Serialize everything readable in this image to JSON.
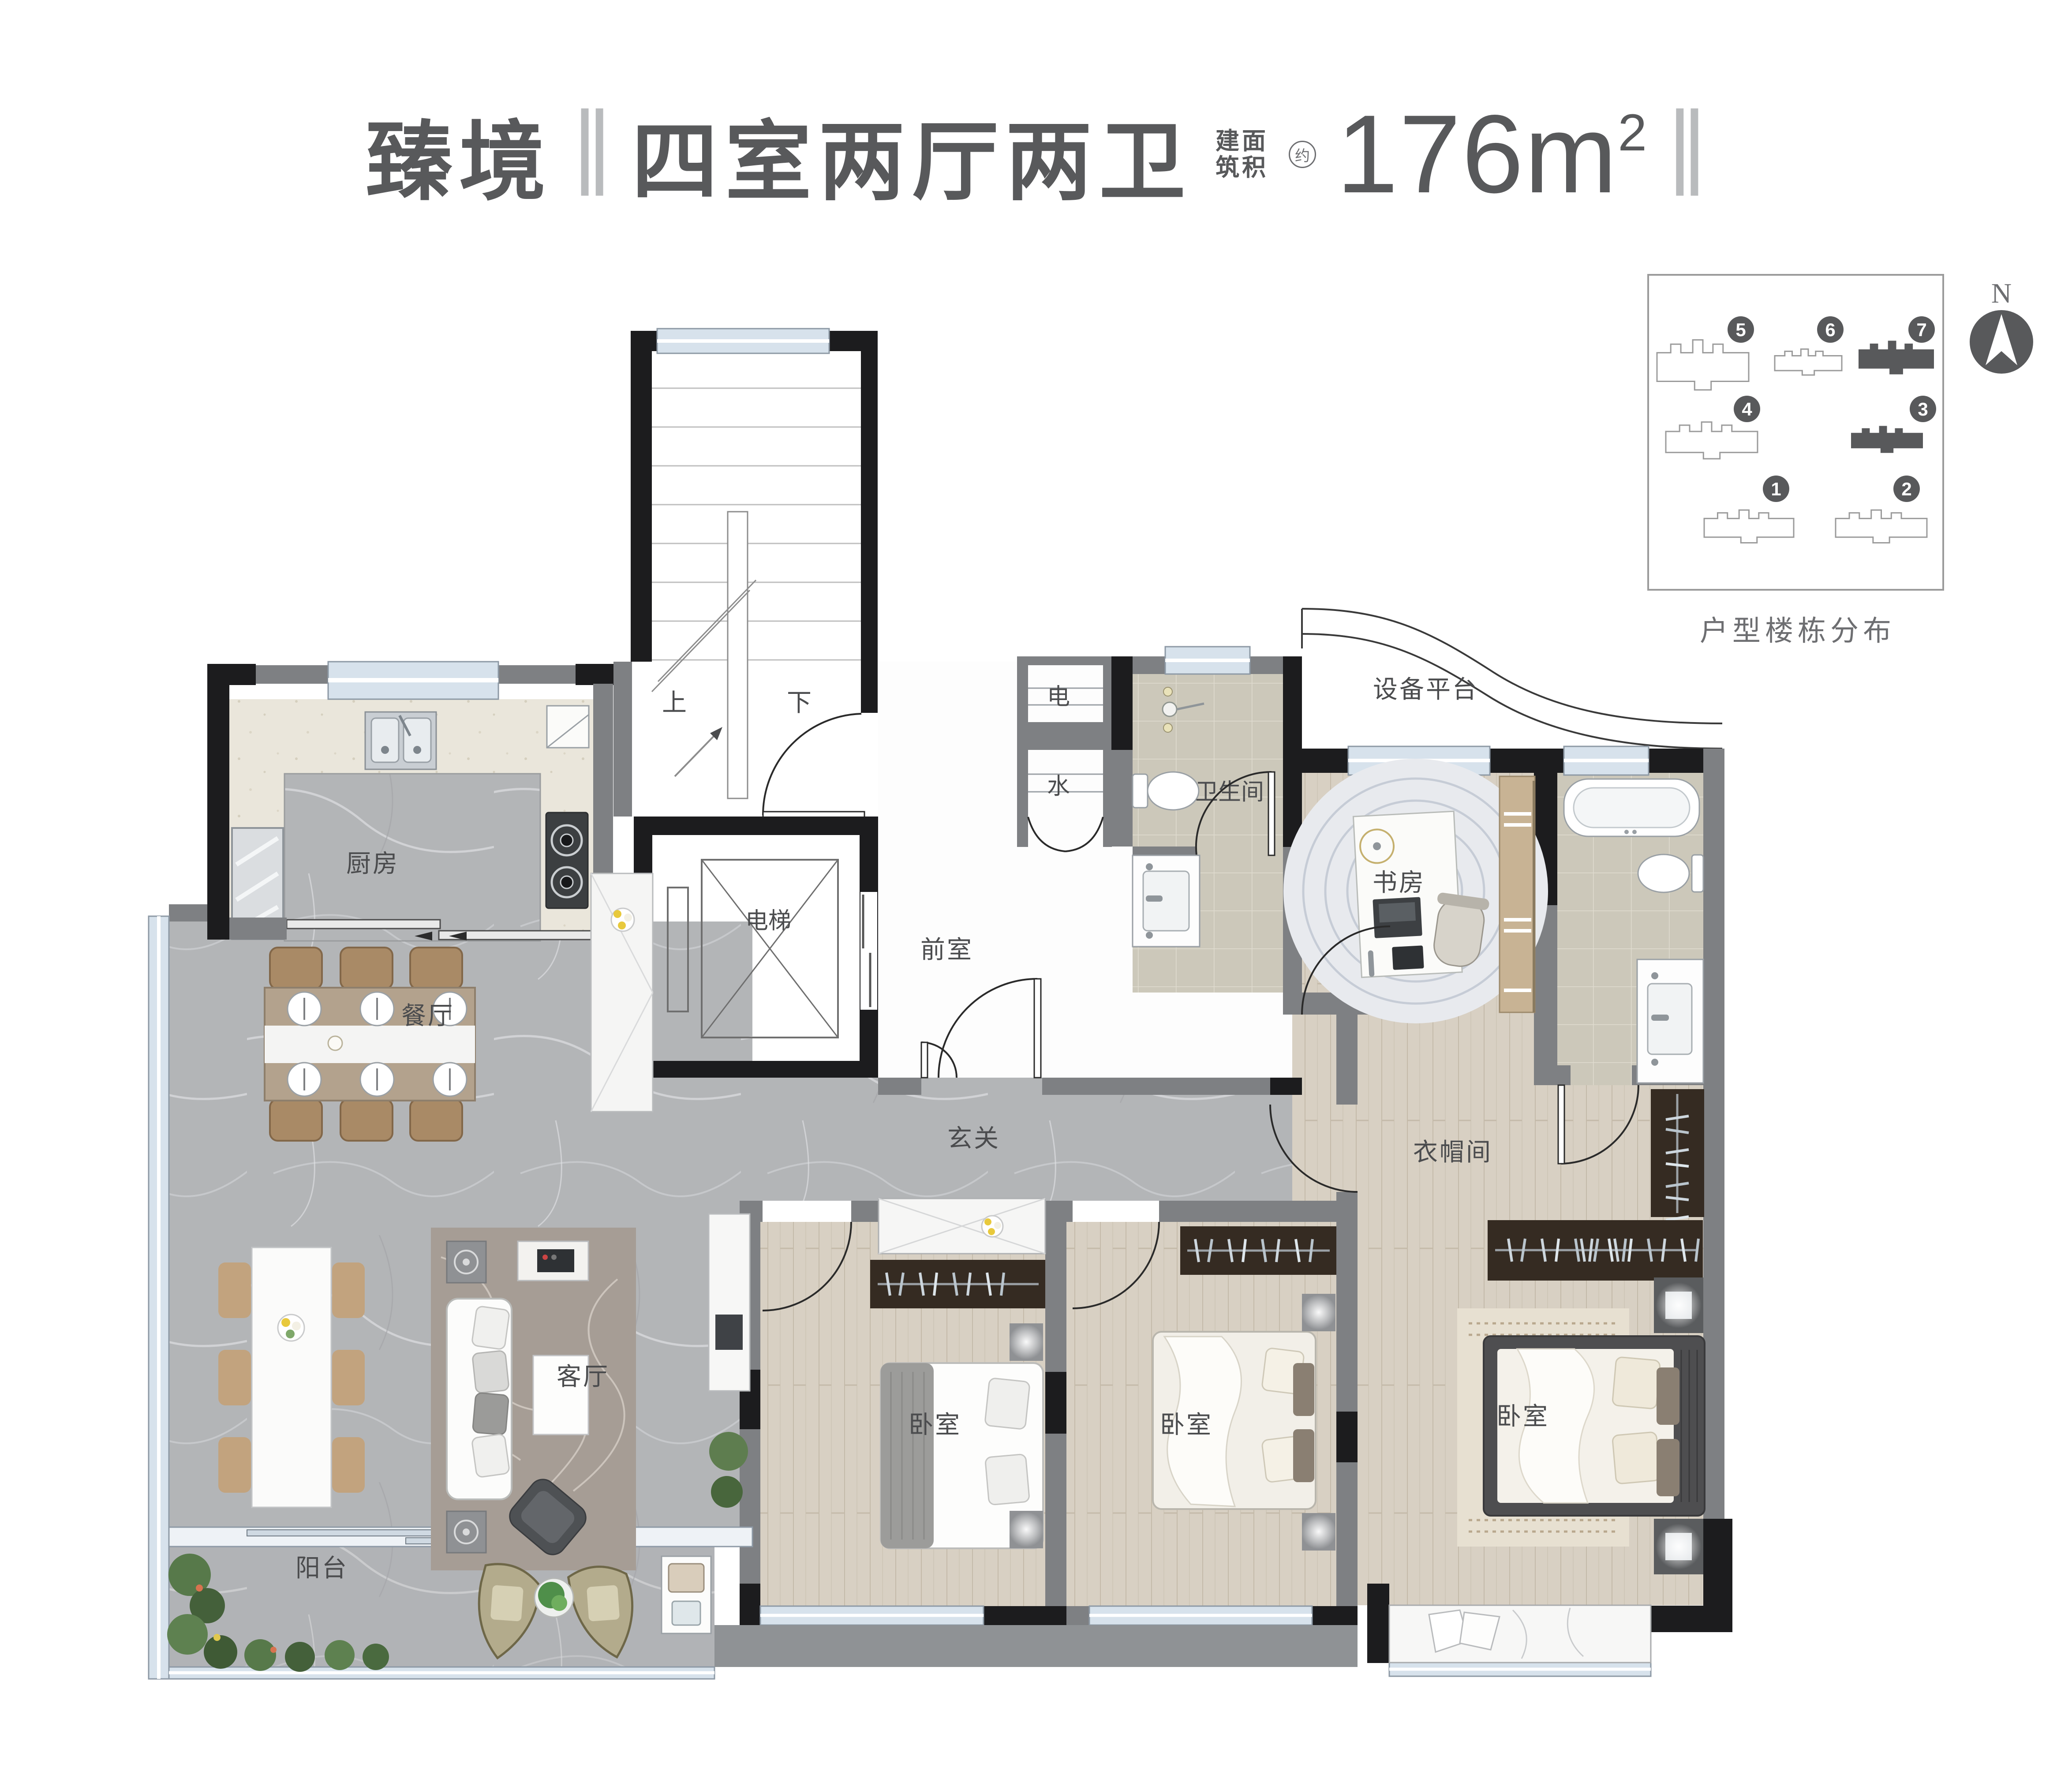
{
  "title": {
    "project": "臻境",
    "separator": "‖",
    "layout": "四室两厅两卫",
    "area_prefix_rows": [
      "建面",
      "筑积"
    ],
    "area_approx": "约",
    "area_value": "176",
    "area_unit": "m",
    "area_sup": "2"
  },
  "legend": {
    "caption": "户型楼栋分布",
    "north_label": "N",
    "highlighted_buildings": [
      "3",
      "7"
    ],
    "buildings": [
      {
        "no": "5",
        "filled": false
      },
      {
        "no": "6",
        "filled": false
      },
      {
        "no": "7",
        "filled": true
      },
      {
        "no": "4",
        "filled": false
      },
      {
        "no": "3",
        "filled": true
      },
      {
        "no": "1",
        "filled": false
      },
      {
        "no": "2",
        "filled": false
      }
    ]
  },
  "rooms": {
    "kitchen": "厨房",
    "dining": "餐厅",
    "living": "客厅",
    "balcony": "阳台",
    "hall": "玄关",
    "front_room": "前室",
    "elevator": "电梯",
    "stair_up": "上",
    "stair_down": "下",
    "shaft_electric": "电",
    "shaft_water": "水",
    "bathroom": "卫生间",
    "study": "书房",
    "equipment_platform": "设备平台",
    "closet": "衣帽间",
    "bedroom_1": "卧室",
    "bedroom_2": "卧室",
    "bedroom_master": "卧室"
  },
  "colors": {
    "wall_black": "#1c1c1e",
    "wall_gray": "#7e8083",
    "window_blue": "#d7e2ec",
    "marble_floor": "#b3b5b7",
    "wood_floor": "#d8d0c3",
    "tile_floor": "#ccc8ba",
    "accent_dark": "#58595b"
  }
}
